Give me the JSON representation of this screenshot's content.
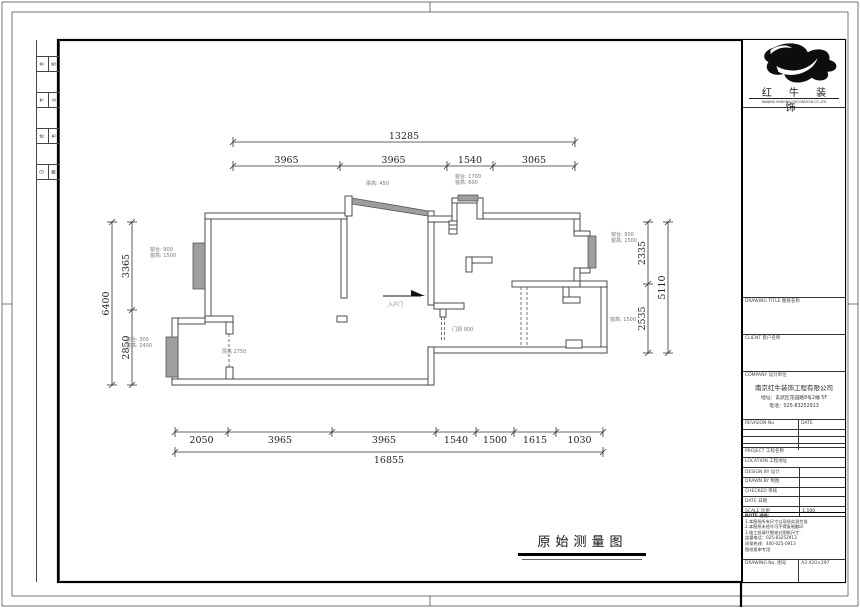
{
  "sheet": {
    "title": "原始测量图"
  },
  "logo": {
    "name": "红 牛 装 饰",
    "tagline": "NANJING HONGNIU DECORATION CO.,LTD"
  },
  "title_block": {
    "sections": {
      "drawing_title": "DRAWING TITLE 图纸名称",
      "client": "CLIENT 客户名称",
      "company_header": "COMPANY 设计单位",
      "project": "PROJECT 工程名称",
      "location": "LOCATION 工程地址",
      "note_header": "NOTE 说明:"
    },
    "company": {
      "name": "南京红牛装饰工程有限公司",
      "address": "地址：玄武区花园路8号2幢 5F",
      "phone": "电话：025-83252913"
    },
    "revision": {
      "col1": "REVISION No.",
      "col2": "DATE"
    },
    "rows": [
      {
        "label": "DESIGN BY 设计",
        "value": ""
      },
      {
        "label": "DRAWN BY 制图",
        "value": ""
      },
      {
        "label": "CHECKED 审核",
        "value": ""
      },
      {
        "label": "DATE 日期",
        "value": ""
      },
      {
        "label": "SCALE 比例",
        "value": "1:100"
      }
    ],
    "notes": [
      "1.本图纸所有尺寸以现场实测为准",
      "2.本图纸未经许可不得复制翻印",
      "3.施工前请仔细核对图纸尺寸",
      "监督电话：025-83252913",
      "质保热线：400-025-0913",
      "图纸报审专用"
    ],
    "bottom": {
      "left": "DRAWING No. 图号",
      "right": "A3 420×297"
    }
  },
  "margin_cells": [
    [
      "会",
      "签"
    ],
    [
      "专",
      "业"
    ],
    [
      "姓",
      "名"
    ],
    [
      "日",
      "期"
    ]
  ],
  "dim_chains": [
    {
      "dir": "h",
      "y": 142,
      "ticks": [
        233,
        575
      ],
      "labels": [
        "13285"
      ],
      "side": "above"
    },
    {
      "dir": "h",
      "y": 166,
      "ticks": [
        233,
        340,
        447,
        493,
        575
      ],
      "labels": [
        "3965",
        "3965",
        "1540",
        "3065"
      ],
      "side": "above"
    },
    {
      "dir": "h",
      "y": 432,
      "ticks": [
        175,
        228,
        332,
        436,
        476,
        514,
        556,
        603
      ],
      "labels": [
        "2050",
        "3965",
        "3965",
        "1540",
        "1500",
        "1615",
        "1030"
      ],
      "side": "below"
    },
    {
      "dir": "h",
      "y": 452,
      "ticks": [
        175,
        603
      ],
      "labels": [
        "16855"
      ],
      "side": "below"
    },
    {
      "dir": "v",
      "x": 132,
      "ticks": [
        222,
        310,
        385
      ],
      "labels": [
        "3365",
        "2850"
      ]
    },
    {
      "dir": "v",
      "x": 112,
      "ticks": [
        222,
        385
      ],
      "labels": [
        "6400"
      ]
    },
    {
      "dir": "v",
      "x": 648,
      "ticks": [
        222,
        284,
        353
      ],
      "labels": [
        "2335",
        "2535"
      ]
    },
    {
      "dir": "v",
      "x": 668,
      "ticks": [
        222,
        353
      ],
      "labels": [
        "5110"
      ]
    }
  ],
  "annotations": [
    {
      "x": 150,
      "y": 251,
      "lines": [
        "窗台: 900",
        "窗高: 1500"
      ]
    },
    {
      "x": 126,
      "y": 341,
      "lines": [
        "窗台: 300",
        "窗高: 2400"
      ]
    },
    {
      "x": 366,
      "y": 185,
      "lines": [
        "梁高: 450"
      ]
    },
    {
      "x": 455,
      "y": 178,
      "lines": [
        "窗台: 1700",
        "窗高: 600"
      ]
    },
    {
      "x": 611,
      "y": 236,
      "lines": [
        "窗台: 900",
        "窗高: 1500"
      ]
    },
    {
      "x": 610,
      "y": 321,
      "lines": [
        "窗高: 1500"
      ]
    },
    {
      "x": 388,
      "y": 306,
      "lines": [
        "入户门"
      ]
    },
    {
      "x": 452,
      "y": 331,
      "lines": [
        "门洞 900"
      ]
    },
    {
      "x": 222,
      "y": 353,
      "lines": [
        "层高 2750"
      ]
    }
  ]
}
